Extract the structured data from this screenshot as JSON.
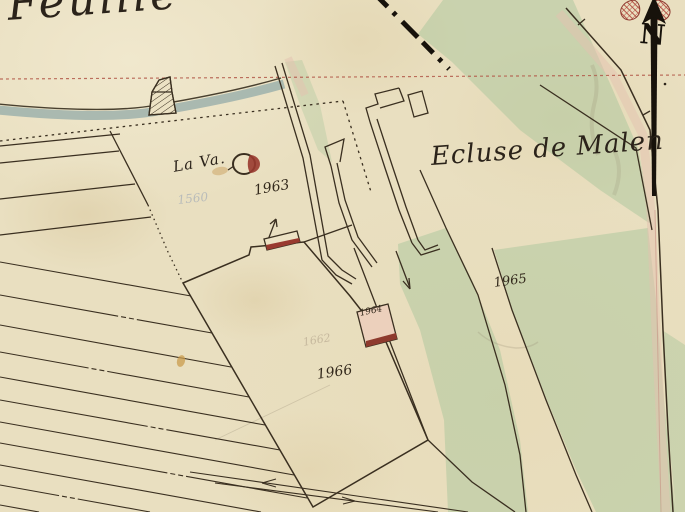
{
  "map": {
    "sheet_title": "Feuille",
    "place_label": "Ecluse de Malen",
    "secondary_label": "La Va.",
    "parcels": {
      "p1963": "1963",
      "p1964": "1964",
      "p1965": "1965",
      "p1966": "1966"
    },
    "pencil_annotations": {
      "a1": "1560",
      "a2": "1662"
    },
    "compass": {
      "north_letter": "N"
    },
    "icons": {
      "north_arrow": "north-arrow",
      "flow_arrow": "flow-direction-arrow",
      "well": "well-structure",
      "bridge": "hatched-bridge-structure"
    },
    "colors": {
      "paper": "#ece2c4",
      "ink": "#3a2f20",
      "ink_dark": "#17120b",
      "water_green": "#a9c69c",
      "stream_blue": "#9db1ab",
      "bank_pink": "#e3c2b0",
      "red_detail": "#993a2f",
      "red_line": "#b35a4a",
      "pencil_blue": "#93a0b5"
    }
  }
}
